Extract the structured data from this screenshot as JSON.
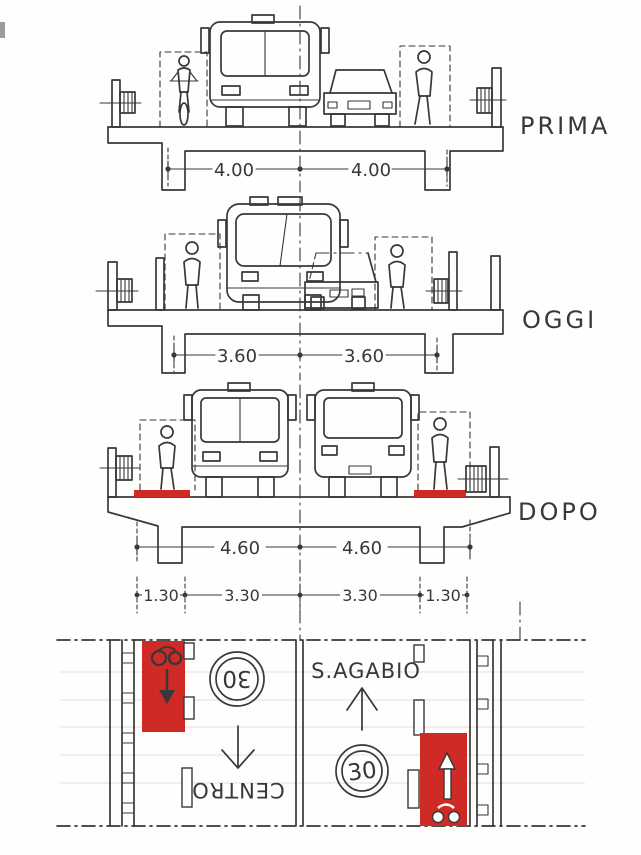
{
  "title": "Hand-drawn street cross-sections and plan (before / today / after)",
  "colors": {
    "ink": "#383838",
    "red": "#cf2a26",
    "paper": "#fffefd"
  },
  "sections": [
    {
      "id": "prima",
      "label": "PRIMA",
      "dim_left": "4.00",
      "dim_right": "4.00"
    },
    {
      "id": "oggi",
      "label": "OGGI",
      "dim_left": "3.60",
      "dim_right": "3.60"
    },
    {
      "id": "dopo",
      "label": "DOPO",
      "dim_left": "4.60",
      "dim_right": "4.60",
      "sub_dims": [
        "1.30",
        "3.30",
        "3.30",
        "1.30"
      ]
    }
  ],
  "plan": {
    "left_lane": {
      "speed_sign": "30",
      "destination": "CENTRO"
    },
    "right_lane": {
      "speed_sign": "30",
      "destination": "S.AGABIO"
    }
  }
}
